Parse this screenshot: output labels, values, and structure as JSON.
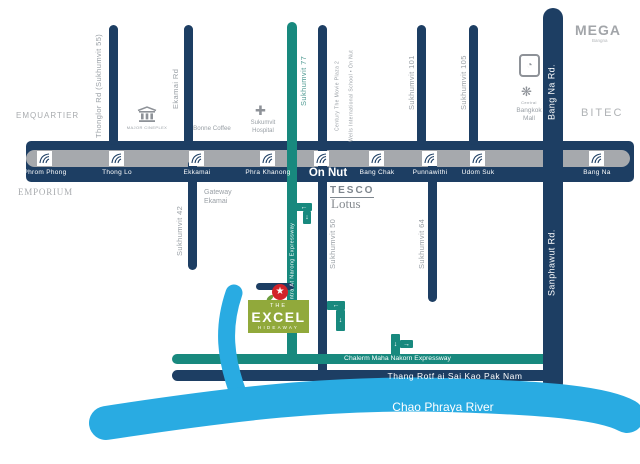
{
  "bts": {
    "stations": [
      "Phrom Phong",
      "Thong Lo",
      "Ekkamai",
      "Phra Khanong",
      "Bang Chak",
      "Punnawithi",
      "Udom Suk",
      "Bang Na"
    ],
    "onnut": "On Nut"
  },
  "roads": {
    "thonglor": "Thonglor Rd (Sukhumvit 55)",
    "ekamai": "Ekamai Rd",
    "sukhumvit77": "Sukhumvit 77",
    "sukhumvit101": "Sukhumvit 101",
    "sukhumvit105": "Sukhumvit 105",
    "bangna": "Bang Na Rd.",
    "sukhumvit42": "Sukhumvit 42",
    "sukhumvit50": "Sukhumvit 50",
    "sukhumvit64": "Sukhumvit 64",
    "sanphawut": "Sanphawut Rd.",
    "ramintra": "Ram Intra At Narong Expressway",
    "chalerm": "Chalerm Maha Nakorn Expressway",
    "thangrotfai": "Thang Rotf ai Sai Kao Pak Nam"
  },
  "pois": {
    "emquartier": "EMQUARTIER",
    "emporium": "EMPORIUM",
    "major_cineplex": "MAJOR CINEPLEX",
    "bonne_coffee": "Bonne Coffee",
    "sukumvit_hospital": "Sukumvit Hospital",
    "gateway_ekamai": "Gateway Ekamai",
    "tesco": "TESCO",
    "lotus": "Lotus",
    "century_movie_plaza": "Century The Movie Plaza 2",
    "wells_school": "Wells International School • On Nut",
    "central": "Central",
    "bangkok_mall": "Bangkok Mall",
    "mega": "MEGA",
    "mega_sub": "Bangna",
    "bitec": "BITEC"
  },
  "landmark": {
    "the": "THE",
    "excel": "EXCEL",
    "hideaway": "HIDEAWAY"
  },
  "river": {
    "label": "Chao Phraya River"
  },
  "icons": {
    "star": "★",
    "cross": "✚",
    "flower": "❋",
    "circle_logo": "◔",
    "arrow_left": "←",
    "arrow_down": "↓",
    "arrow_right": "→"
  },
  "colors": {
    "navy": "#1d3e63",
    "gray_line": "#a6a9ad",
    "teal": "#18897e",
    "green": "#91a93b",
    "red": "#d2232a",
    "river_blue": "#29abe2"
  }
}
